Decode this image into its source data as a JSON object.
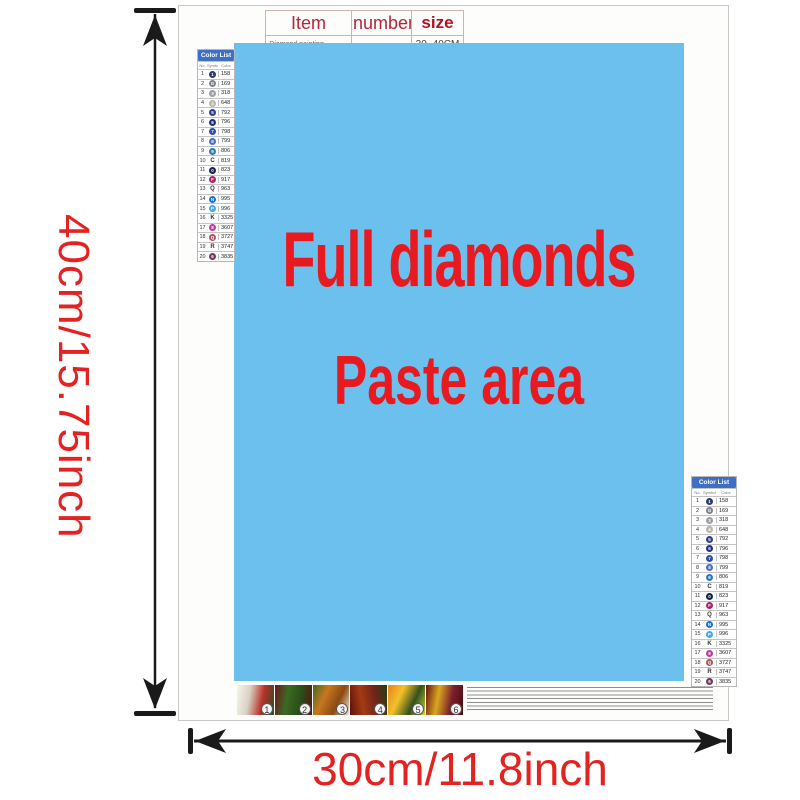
{
  "dimensions": {
    "height_label": "40cm/15.75inch",
    "width_label": "30cm/11.8inch",
    "label_color": "#e32222"
  },
  "item_table": {
    "headers": [
      "Item",
      "number",
      "size"
    ],
    "row": [
      "Diamond painting",
      "",
      "30~40CM"
    ]
  },
  "paste_area": {
    "line1": "Full diamonds",
    "line2": "Paste area",
    "bg": "#6bc0ee",
    "text_color": "#e8191f"
  },
  "color_list": {
    "title": "Color List",
    "header_bg": "#3e6fc4",
    "columns": [
      "No.",
      "Symbol",
      "Color"
    ],
    "rows": [
      {
        "no": "1",
        "glyph": "1",
        "type": "circle",
        "color": "#2c3a75",
        "code": "158"
      },
      {
        "no": "2",
        "glyph": "G",
        "type": "circle",
        "color": "#7d828c",
        "code": "169"
      },
      {
        "no": "3",
        "glyph": "3",
        "type": "circle",
        "color": "#9b9ea6",
        "code": "318"
      },
      {
        "no": "4",
        "glyph": "4",
        "type": "circle",
        "color": "#b5b5ad",
        "code": "648"
      },
      {
        "no": "5",
        "glyph": "5",
        "type": "circle",
        "color": "#333d8f",
        "code": "792"
      },
      {
        "no": "6",
        "glyph": "6",
        "type": "circle",
        "color": "#21307f",
        "code": "796"
      },
      {
        "no": "7",
        "glyph": "7",
        "type": "circle",
        "color": "#2f4da8",
        "code": "798"
      },
      {
        "no": "8",
        "glyph": "8",
        "type": "circle",
        "color": "#4a6cc4",
        "code": "799"
      },
      {
        "no": "9",
        "glyph": "9",
        "type": "circle",
        "color": "#2d7bb5",
        "code": "806"
      },
      {
        "no": "10",
        "glyph": "C",
        "type": "letter",
        "color": "#444444",
        "code": "819"
      },
      {
        "no": "11",
        "glyph": "0",
        "type": "circle",
        "color": "#17234f",
        "code": "823"
      },
      {
        "no": "12",
        "glyph": "F",
        "type": "circle",
        "color": "#a82465",
        "code": "917"
      },
      {
        "no": "13",
        "glyph": "Q",
        "type": "letter",
        "color": "#444444",
        "code": "963"
      },
      {
        "no": "14",
        "glyph": "N",
        "type": "circle",
        "color": "#1b6fd0",
        "code": "995"
      },
      {
        "no": "15",
        "glyph": "P",
        "type": "circle",
        "color": "#42a9e8",
        "code": "996"
      },
      {
        "no": "16",
        "glyph": "K",
        "type": "letter",
        "color": "#444444",
        "code": "3325"
      },
      {
        "no": "17",
        "glyph": "8",
        "type": "circle",
        "color": "#c0399d",
        "code": "3607"
      },
      {
        "no": "18",
        "glyph": "Q",
        "type": "circle",
        "color": "#a85560",
        "code": "3727"
      },
      {
        "no": "19",
        "glyph": "R",
        "type": "letter",
        "color": "#444444",
        "code": "3747"
      },
      {
        "no": "20",
        "glyph": "6",
        "type": "circle",
        "color": "#6e3a5e",
        "code": "3835"
      }
    ]
  },
  "footer": {
    "thumbs": [
      {
        "label": "1",
        "angle": 100,
        "colors": [
          "#f7f4ea",
          "#d8d2c2",
          "#b8312a",
          "#274e1c"
        ]
      },
      {
        "label": "2",
        "angle": 100,
        "colors": [
          "#6e1420",
          "#3a6b22",
          "#2a4d18",
          "#5a0f14"
        ]
      },
      {
        "label": "3",
        "angle": 115,
        "colors": [
          "#3f6b1e",
          "#c8761f",
          "#8a4a12",
          "#f0e8d8"
        ]
      },
      {
        "label": "4",
        "angle": 80,
        "colors": [
          "#5e1010",
          "#a33b12",
          "#70241c",
          "#243d12"
        ]
      },
      {
        "label": "5",
        "angle": 115,
        "colors": [
          "#e8821c",
          "#f2c12c",
          "#35511c",
          "#c8d434"
        ]
      },
      {
        "label": "6",
        "angle": 100,
        "colors": [
          "#6b1012",
          "#d8a81e",
          "#7c1f2e",
          "#4a0d10"
        ]
      }
    ]
  }
}
